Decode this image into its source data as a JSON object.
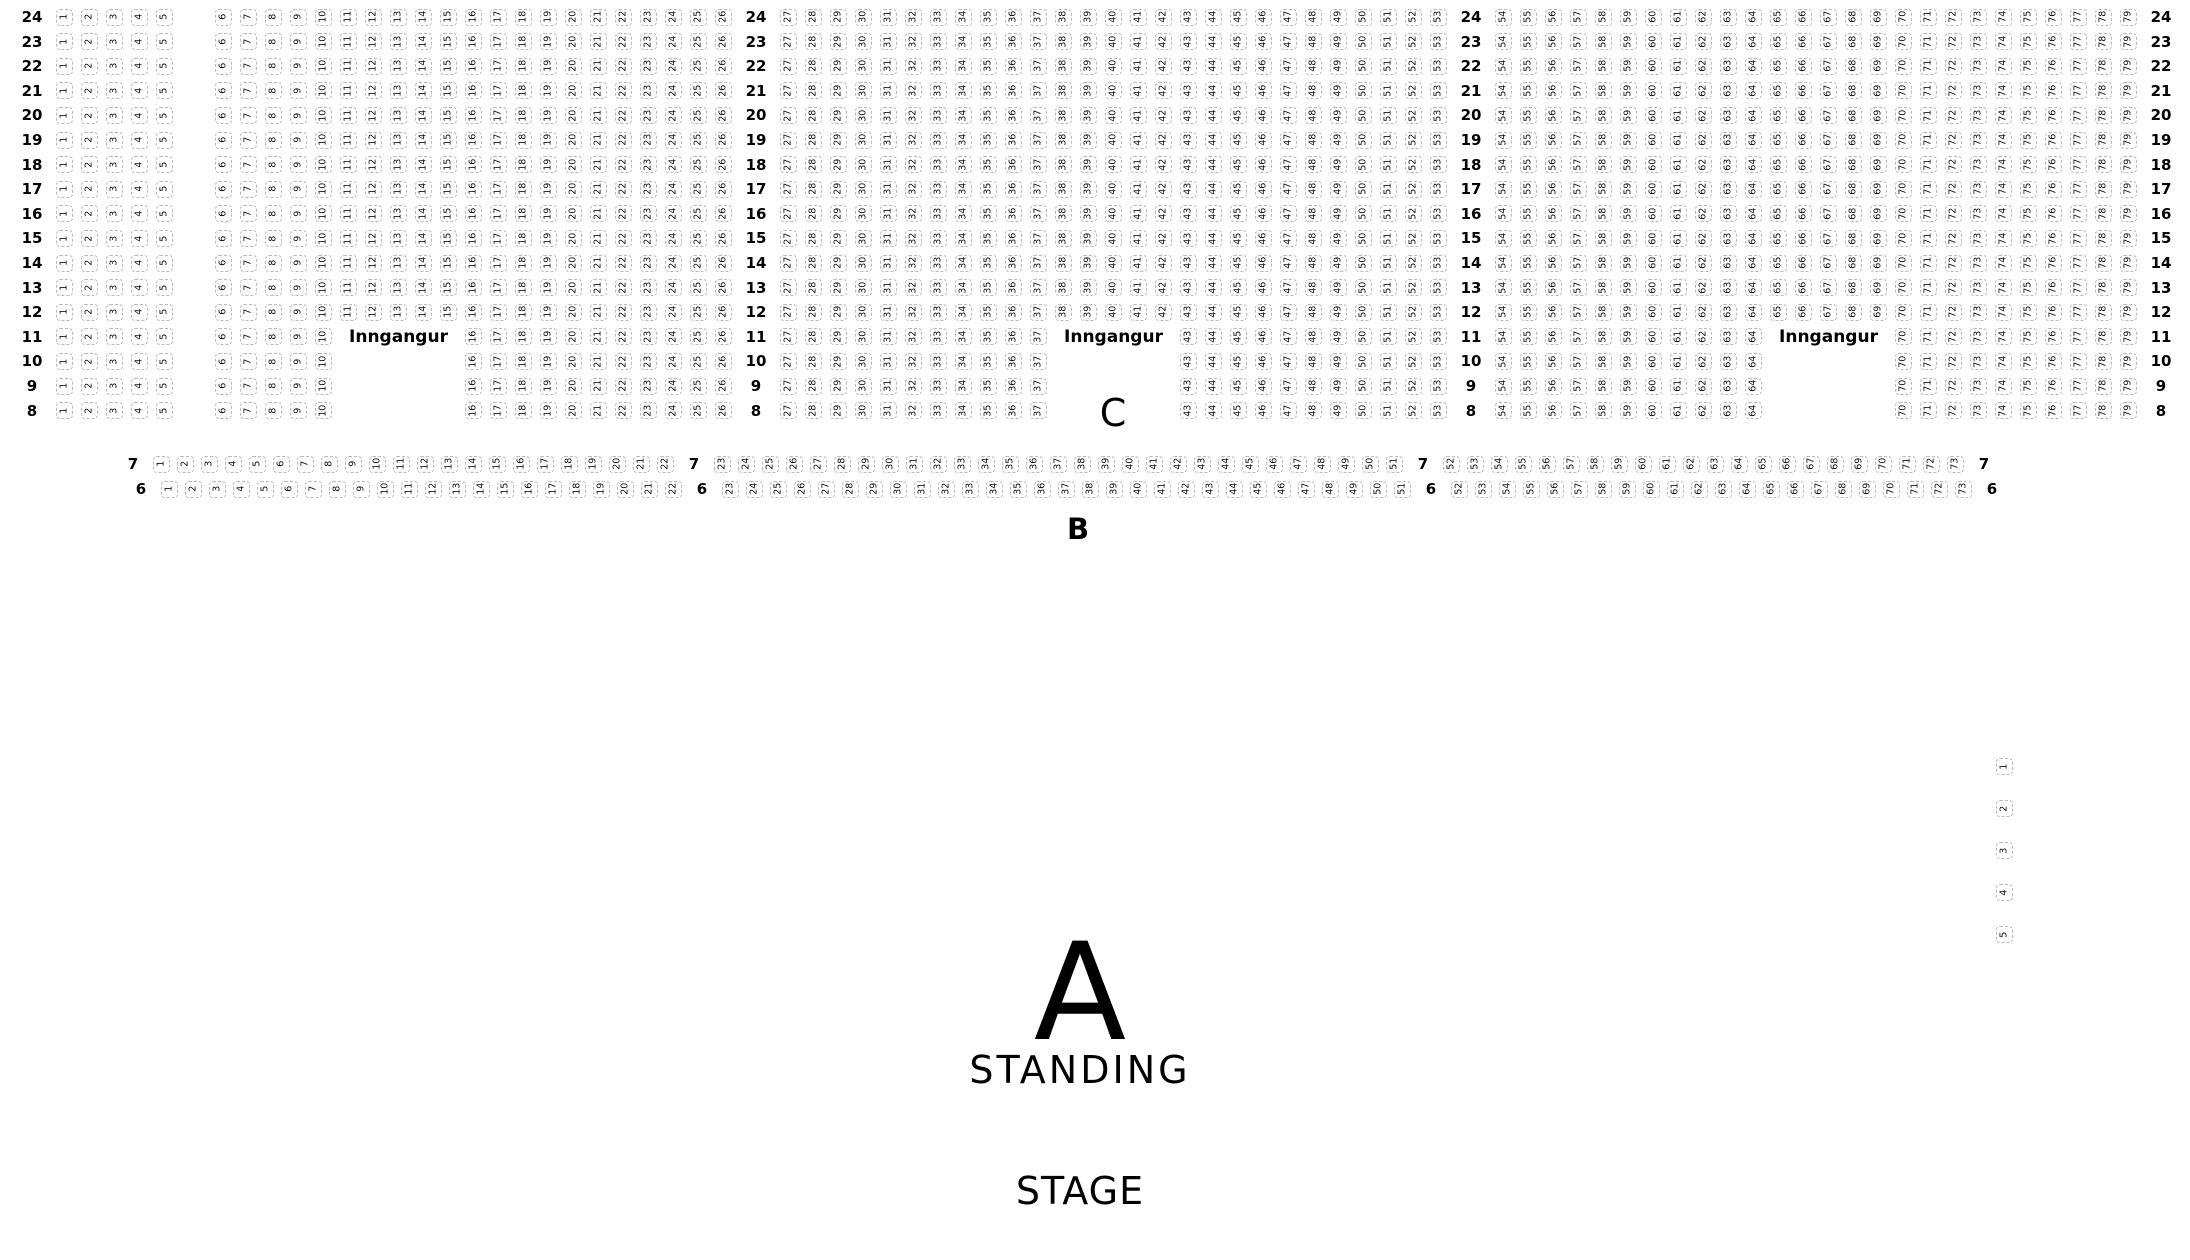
{
  "sections": {
    "c_label": "C",
    "b_label": "B",
    "a_label": "A",
    "standing_label": "STANDING"
  },
  "stage_label": "STAGE",
  "seat_map": {
    "entrance_label": "Inngangur",
    "row_templates": {
      "c_full": [
        {
          "t": "label"
        },
        {
          "t": "seats",
          "from": 1,
          "to": 5
        },
        {
          "t": "aisle"
        },
        {
          "t": "seats",
          "from": 6,
          "to": 26
        },
        {
          "t": "label"
        },
        {
          "t": "seats",
          "from": 27,
          "to": 53
        },
        {
          "t": "label"
        },
        {
          "t": "seats",
          "from": 54,
          "to": 79
        },
        {
          "t": "label"
        }
      ],
      "c_entrance": [
        {
          "t": "label"
        },
        {
          "t": "seats",
          "from": 1,
          "to": 5
        },
        {
          "t": "aisle"
        },
        {
          "t": "seats",
          "from": 6,
          "to": 10
        },
        {
          "t": "entrance"
        },
        {
          "t": "seats",
          "from": 16,
          "to": 26
        },
        {
          "t": "label"
        },
        {
          "t": "seats",
          "from": 27,
          "to": 37
        },
        {
          "t": "entrance"
        },
        {
          "t": "seats",
          "from": 43,
          "to": 53
        },
        {
          "t": "label"
        },
        {
          "t": "seats",
          "from": 54,
          "to": 64
        },
        {
          "t": "entrance"
        },
        {
          "t": "seats",
          "from": 70,
          "to": 79
        },
        {
          "t": "label"
        }
      ],
      "b": [
        {
          "t": "label"
        },
        {
          "t": "seats",
          "from": 1,
          "to": 22
        },
        {
          "t": "label"
        },
        {
          "t": "seats",
          "from": 23,
          "to": 51
        },
        {
          "t": "label"
        },
        {
          "t": "seats",
          "from": 52,
          "to": 73
        },
        {
          "t": "label"
        }
      ]
    },
    "rows": [
      {
        "section": "C",
        "row": 24,
        "template": "c_full"
      },
      {
        "section": "C",
        "row": 23,
        "template": "c_full"
      },
      {
        "section": "C",
        "row": 22,
        "template": "c_full"
      },
      {
        "section": "C",
        "row": 21,
        "template": "c_full"
      },
      {
        "section": "C",
        "row": 20,
        "template": "c_full"
      },
      {
        "section": "C",
        "row": 19,
        "template": "c_full"
      },
      {
        "section": "C",
        "row": 18,
        "template": "c_full"
      },
      {
        "section": "C",
        "row": 17,
        "template": "c_full"
      },
      {
        "section": "C",
        "row": 16,
        "template": "c_full"
      },
      {
        "section": "C",
        "row": 15,
        "template": "c_full"
      },
      {
        "section": "C",
        "row": 14,
        "template": "c_full"
      },
      {
        "section": "C",
        "row": 13,
        "template": "c_full"
      },
      {
        "section": "C",
        "row": 12,
        "template": "c_full"
      },
      {
        "section": "C",
        "row": 11,
        "template": "c_entrance",
        "entrance_text": true
      },
      {
        "section": "C",
        "row": 10,
        "template": "c_entrance"
      },
      {
        "section": "C",
        "row": 9,
        "template": "c_entrance"
      },
      {
        "section": "C",
        "row": 8,
        "template": "c_entrance"
      },
      {
        "section": "B",
        "row": 7,
        "template": "b"
      },
      {
        "section": "B",
        "row": 6,
        "template": "b",
        "indent": 8
      }
    ],
    "side_seats": [
      "1",
      "2",
      "3",
      "4",
      "5"
    ]
  }
}
